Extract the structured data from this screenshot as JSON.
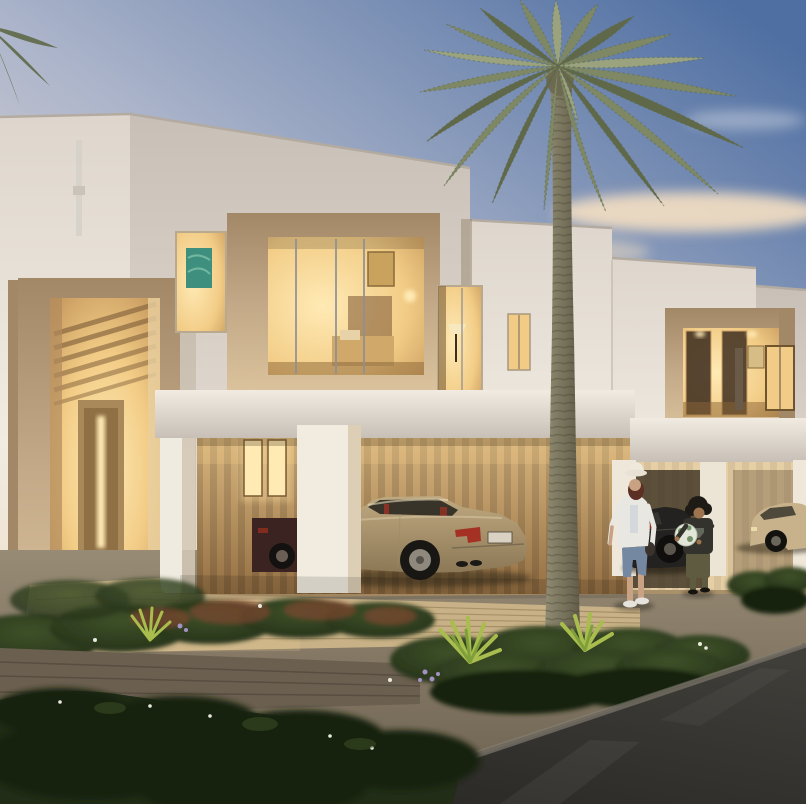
{
  "scene": {
    "description": "Photorealistic dusk rendering of modern two-storey townhouses with warmly lit windows and bay boxes, a beige entrance portal, a carport sheltering a gold sports coupe, a dark car and a champagne sedan, a tall date palm in the centre, layered garden beds with flowering shrubs, a timber walkway, gravel paths and a dark asphalt road in the foreground; a woman in a sun hat watches a child holding a ball",
    "time_of_day": "dusk",
    "people_count": 2,
    "vehicle_count": 4,
    "objects": [
      "sky",
      "clouds",
      "townhouse-facades",
      "entrance-portal",
      "bay-window",
      "lit-windows",
      "carport-canopy",
      "gold-sports-car",
      "garage-car",
      "dark-car",
      "champagne-sedan",
      "woman",
      "child",
      "ball",
      "date-palm",
      "garden-beds",
      "timber-walkway",
      "gravel-strip",
      "asphalt-road",
      "downspout"
    ]
  },
  "colors": {
    "sky_top": "#4f6fa2",
    "sky_mid": "#aeb6cb",
    "sky_low": "#ecdcd4",
    "sky_horizon": "#f0e0d0",
    "cloud_warm": "#f4dfc2",
    "cloud_pale": "#e9dcd8",
    "wall_lit": "#f1ebe1",
    "wall_warm": "#ecdfc9",
    "wall_mid": "#ded6cc",
    "wall_shadow": "#c8c0b7",
    "stone": "#c3a987",
    "stone_dark": "#a28866",
    "stone_light": "#dcc49e",
    "glow": "#f2cc86",
    "glow_bright": "#ffeab4",
    "interior_warm": "#c79a5e",
    "slat_light": "#d8b67f",
    "slat_dark": "#946f43",
    "frame_dark": "#6f5430",
    "teal_art": "#3e8f7e",
    "trunk_light": "#938e74",
    "trunk_dark": "#5f5a46",
    "frond": "#7e8865",
    "frond_dark": "#5f6949",
    "frond_light": "#9aa37e",
    "gravel": "#978b75",
    "gravel_dark": "#6b5f4f",
    "deck": "#c8b186",
    "deck_gap": "#9c865f",
    "green_dark": "#222d18",
    "green_deep": "#19230f",
    "green_mid": "#3e5128",
    "green_bright": "#7f9f3b",
    "green_accent": "#a8bd4d",
    "flower_red": "#7c4631",
    "flower_lilac": "#a392c5",
    "flower_white": "#e9e9df",
    "asphalt": "#2b2a27",
    "asphalt_light": "#403e39",
    "curb": "#6f6a60",
    "car_gold": "#bfa980",
    "car_gold_dark": "#8c7856",
    "car_glass": "#2e2a23",
    "car_red": "#a43124",
    "car_black": "#232220",
    "car_maroon": "#3a2320",
    "sedan": "#c7b28c",
    "skin": "#c9a183",
    "skin_dark": "#9c744f",
    "hair_auburn": "#5b2f24",
    "shirt_white": "#e9e7e2",
    "jeans": "#7488a1",
    "child_top": "#34322c",
    "child_pants": "#5e5b41",
    "ball": "#e2e7da",
    "ball_patch": "#5e7f52"
  }
}
